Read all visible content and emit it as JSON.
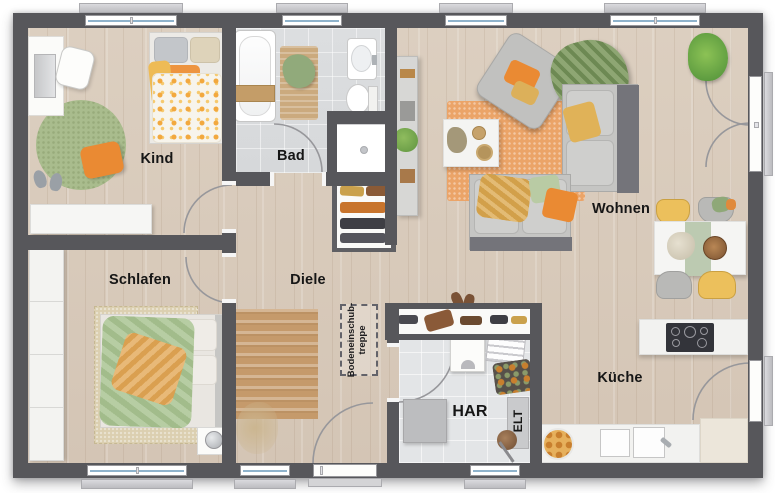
{
  "rooms": [
    {
      "id": "kind",
      "label": "Kind"
    },
    {
      "id": "bad",
      "label": "Bad"
    },
    {
      "id": "wohnen",
      "label": "Wohnen"
    },
    {
      "id": "schlafen",
      "label": "Schlafen"
    },
    {
      "id": "diele",
      "label": "Diele"
    },
    {
      "id": "har",
      "label": "HAR"
    },
    {
      "id": "kueche",
      "label": "Küche"
    }
  ],
  "annotations": {
    "elt_label": "ELT",
    "attic_hatch": {
      "line1": "Bodeneinschub-",
      "line2": "treppe"
    }
  },
  "colors": {
    "wall": "#57575b",
    "wood_floor": "#d8cabb",
    "bath_tile": "#dadcde",
    "har_tile": "#e3e5e7",
    "accent_orange": "#ea8a33",
    "accent_yellow": "#e0b258",
    "accent_green": "#a9bc8d",
    "rug_orange": "#eba468",
    "label_color": "#161616"
  }
}
